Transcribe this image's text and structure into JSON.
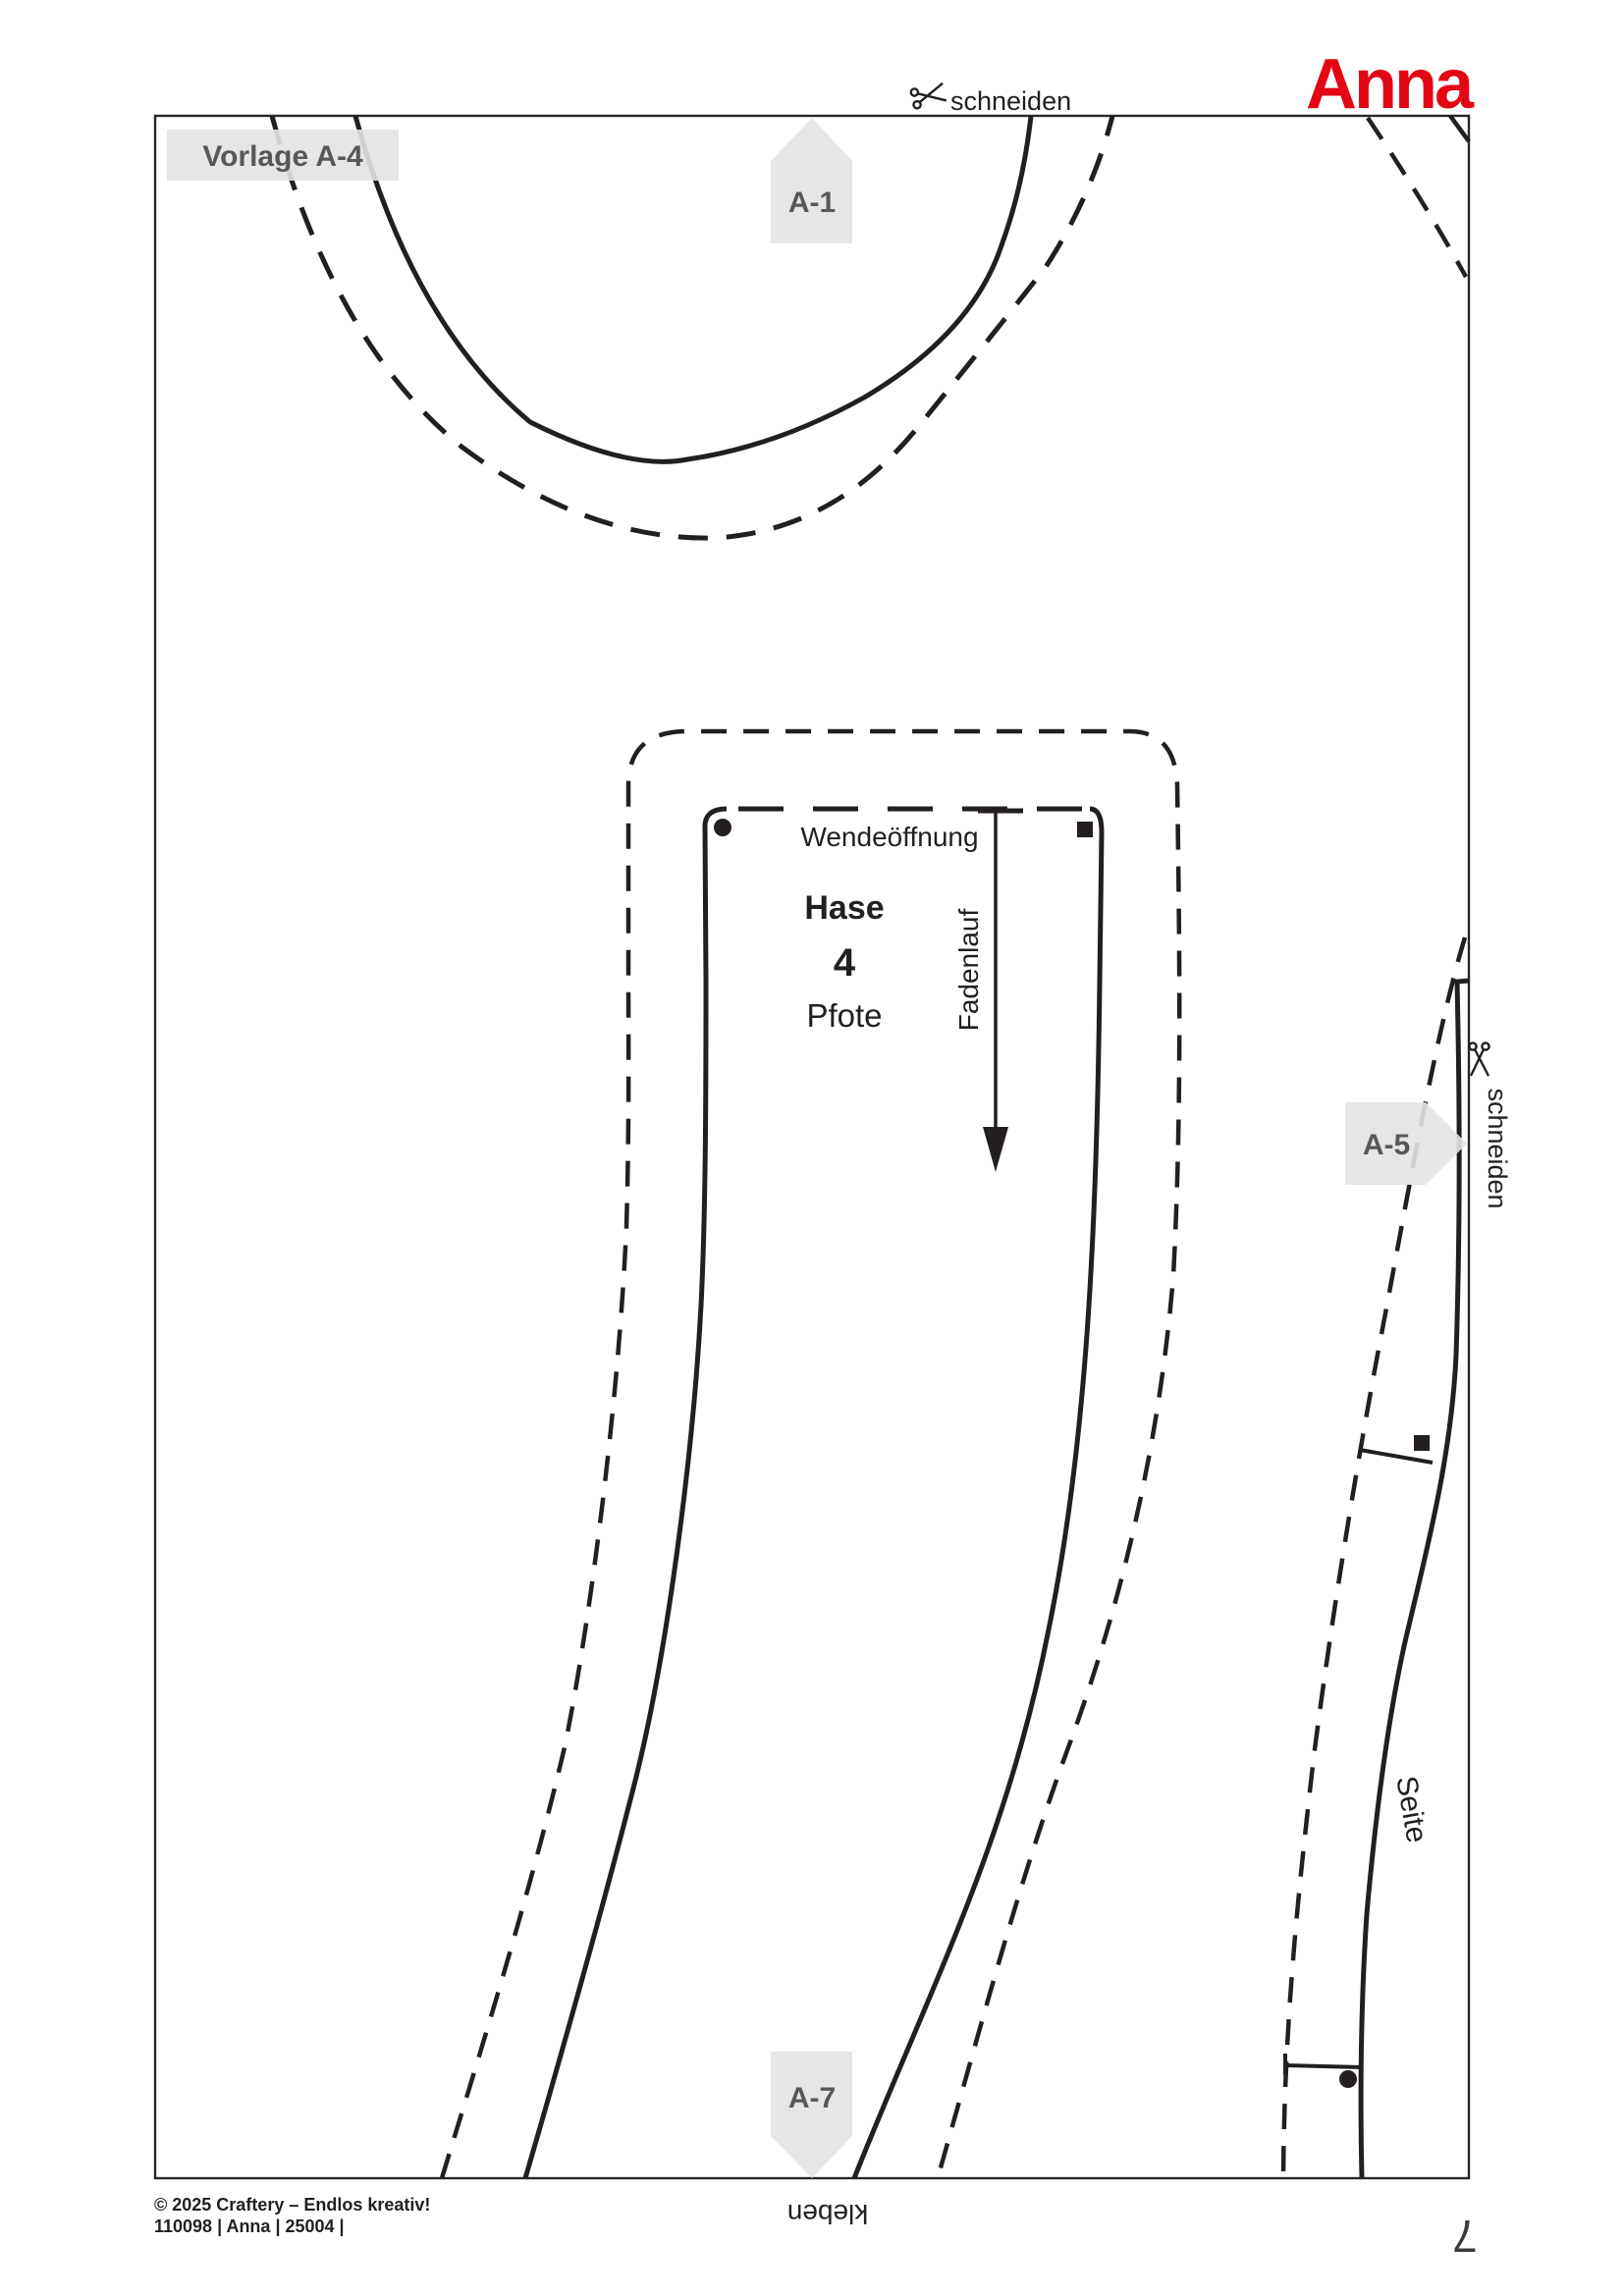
{
  "page": {
    "brand": "Anna",
    "template_label": "Vorlage A-4",
    "cut_label_top": "schneiden",
    "cut_label_right": "schneiden",
    "glue_label": "kleben",
    "page_number": "7",
    "footer_line1": "© 2025 Craftery – Endlos kreativ!",
    "footer_line2": "110098 | Anna | 25004 |"
  },
  "markers": {
    "a1": {
      "label": "A-1"
    },
    "a5": {
      "label": "A-5"
    },
    "a7": {
      "label": "A-7"
    }
  },
  "pattern_piece": {
    "animal": "Hase",
    "piece_number": "4",
    "piece_name": "Pfote",
    "opening_label": "Wendeöffnung",
    "grainline_label": "Fadenlauf",
    "side_label": "Seite"
  },
  "colors": {
    "accent_red": "#e30613",
    "line": "#231f20",
    "marker_gray": "#e3e3e3",
    "marker_text": "#57585a"
  }
}
